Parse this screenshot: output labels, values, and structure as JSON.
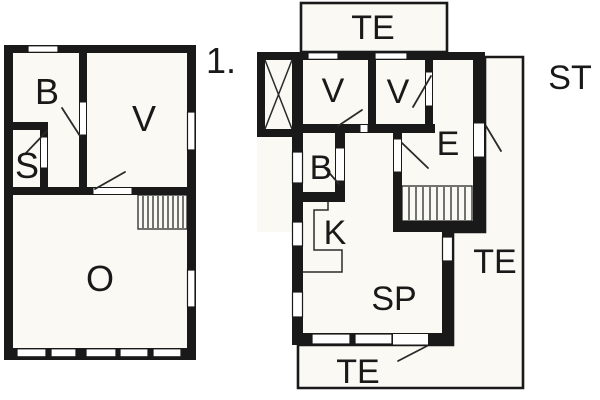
{
  "figure": {
    "type": "architectural-floor-plan",
    "background": "#ffffff",
    "wall_color": "#191919",
    "floor_color": "#faf9f4"
  },
  "ground_floor": {
    "rooms": {
      "b": "B",
      "v": "V",
      "s": "S",
      "o": "O"
    }
  },
  "upper_floor": {
    "floor_label": "1.",
    "rooms": {
      "te_top": "TE",
      "v1": "V",
      "v2": "V",
      "e": "E",
      "b": "B",
      "k": "K",
      "sp": "SP",
      "te_right": "TE",
      "te_bottom": "TE",
      "st": "ST"
    }
  }
}
